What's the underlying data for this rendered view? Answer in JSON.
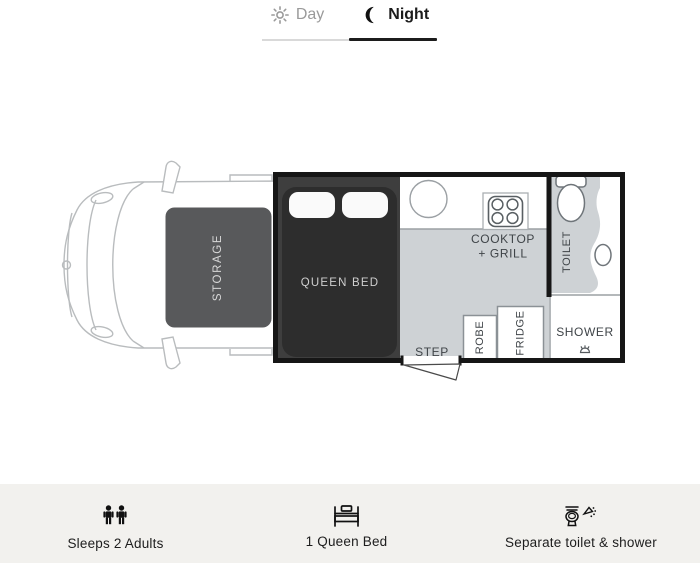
{
  "tabs": {
    "day": "Day",
    "night": "Night"
  },
  "plan": {
    "storage": "STORAGE",
    "queen_bed": "QUEEN BED",
    "cooktop_line1": "COOKTOP",
    "cooktop_line2": "+ GRILL",
    "step": "STEP",
    "robe": "ROBE",
    "fridge": "FRIDGE",
    "toilet": "TOILET",
    "shower": "SHOWER"
  },
  "features": [
    {
      "icon": "people-icon",
      "label": "Sleeps 2 Adults"
    },
    {
      "icon": "bed-icon",
      "label": "1 Queen Bed"
    },
    {
      "icon": "toilet-shower-icon",
      "label": "Separate toilet & shower"
    }
  ],
  "colors": {
    "tab-active": "#1c1c1c",
    "tab-inactive": "#9a9a9a",
    "line-light": "#d9d9d9",
    "wall": "#161616",
    "floor": "#ced2d5",
    "storage": "#58595b",
    "bed-zone": "#3e3e3e",
    "mattress": "#2d2d2d",
    "pillow": "#fafafa",
    "cab-line": "#b9bcbe",
    "line-grey": "#9ba0a4",
    "fixture-line": "#6f757a",
    "label": "#3f4448",
    "bottombar-bg": "#f2f1ee",
    "icon": "#1d1d1d"
  }
}
